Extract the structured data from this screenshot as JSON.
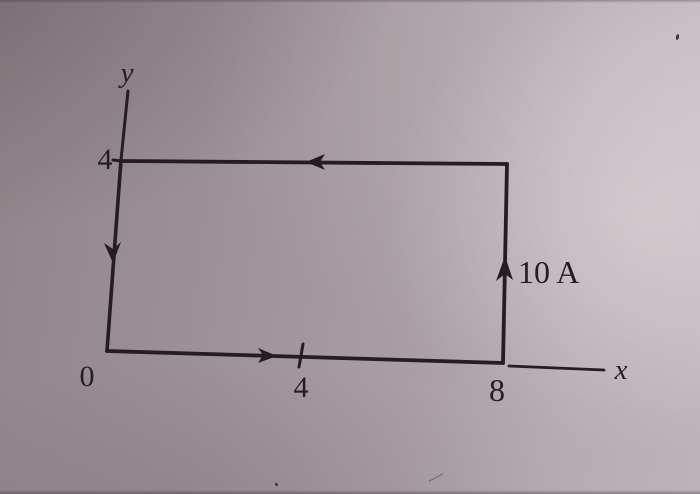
{
  "figure": {
    "description": "Photographed textbook figure: rectangular current-carrying loop drawn on an x-y coordinate plane",
    "labels": {
      "y_axis": "y",
      "x_axis": "x",
      "origin": "0",
      "y_tick_4": "4",
      "x_tick_4": "4",
      "x_tick_8": "8",
      "current": "10 A"
    },
    "loop": {
      "vertices_xy": [
        [
          0,
          0
        ],
        [
          8,
          0
        ],
        [
          8,
          4
        ],
        [
          0,
          4
        ]
      ],
      "current_direction": "counterclockwise",
      "arrows": [
        {
          "side": "bottom",
          "direction": "right"
        },
        {
          "side": "right",
          "direction": "up"
        },
        {
          "side": "top",
          "direction": "left"
        },
        {
          "side": "left",
          "direction": "down"
        }
      ]
    },
    "colors": {
      "ink": "#241d21",
      "paper_mid": "#a0959b",
      "paper_dark": "#8c8287",
      "paper_light": "#bcb3b9"
    }
  }
}
